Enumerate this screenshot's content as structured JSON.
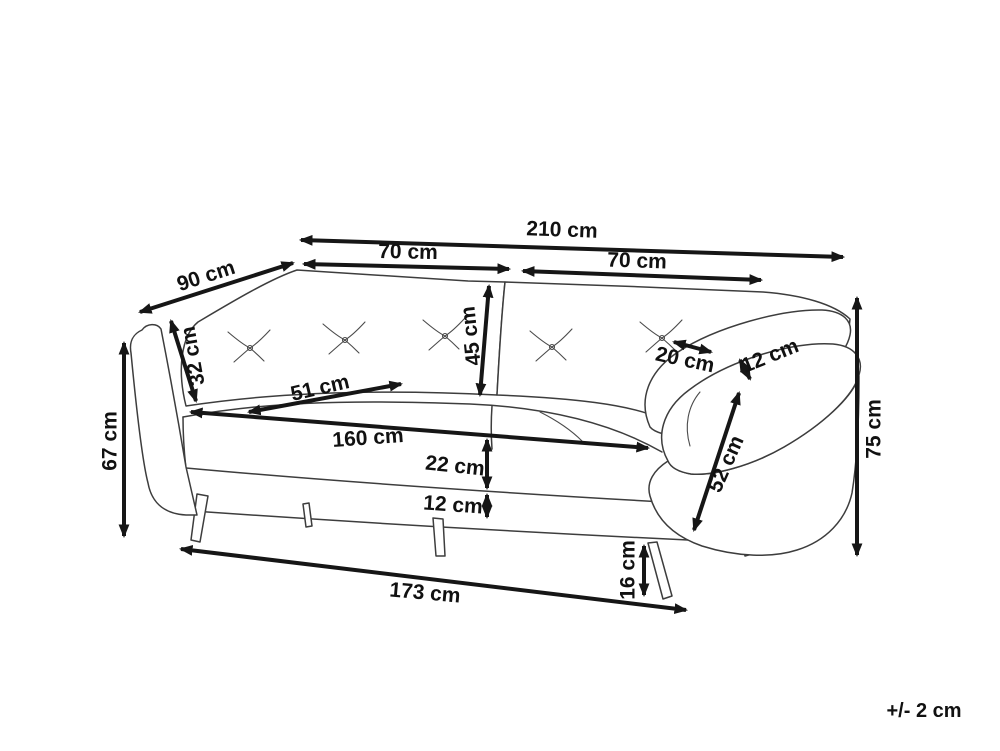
{
  "diagram": {
    "type": "furniture-dimension-diagram",
    "subject": "three-seat sofa line drawing with dimension arrows",
    "units": "cm",
    "tolerance_note": "+/- 2 cm",
    "colors": {
      "background": "#ffffff",
      "sofa_line": "#3d3d3d",
      "dimension_line": "#161616",
      "label_text": "#111111"
    },
    "dimensions": [
      {
        "id": "overall-width",
        "label": "210 cm",
        "value": 210
      },
      {
        "id": "seat-section-left",
        "label": "70 cm",
        "value": 70
      },
      {
        "id": "seat-section-right",
        "label": "70 cm",
        "value": 70
      },
      {
        "id": "overall-depth",
        "label": "90 cm",
        "value": 90
      },
      {
        "id": "back-cushion-height",
        "label": "32 cm",
        "value": 32
      },
      {
        "id": "backrest-height",
        "label": "45 cm",
        "value": 45
      },
      {
        "id": "armrest-top-depth",
        "label": "20 cm",
        "value": 20
      },
      {
        "id": "armrest-thickness",
        "label": "12 cm",
        "value": 12
      },
      {
        "id": "seat-depth",
        "label": "51 cm",
        "value": 51
      },
      {
        "id": "seat-width",
        "label": "160 cm",
        "value": 160
      },
      {
        "id": "seat-band-height",
        "label": "22 cm",
        "value": 22
      },
      {
        "id": "base-rail-height",
        "label": "12 cm",
        "value": 12
      },
      {
        "id": "arm-side-height",
        "label": "67 cm",
        "value": 67
      },
      {
        "id": "overall-height",
        "label": "75 cm",
        "value": 75
      },
      {
        "id": "armrest-front-length",
        "label": "52 cm",
        "value": 52
      },
      {
        "id": "leg-height",
        "label": "16 cm",
        "value": 16
      },
      {
        "id": "base-width",
        "label": "173 cm",
        "value": 173
      }
    ]
  }
}
